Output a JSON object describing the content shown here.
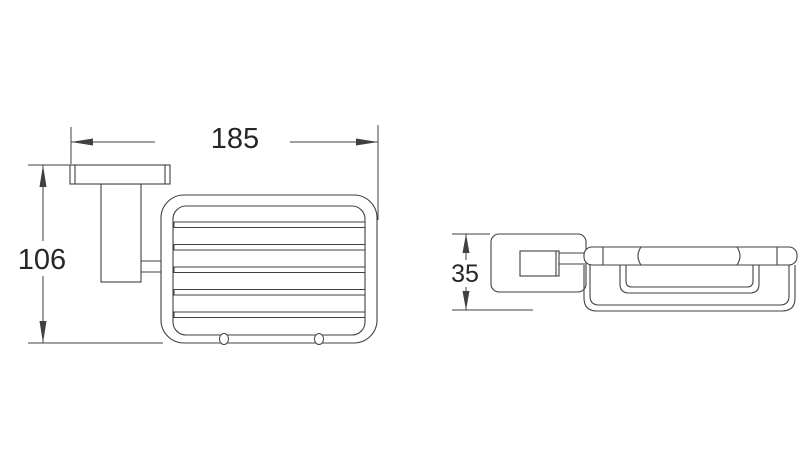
{
  "style": {
    "page_bg": "#ffffff",
    "line_color": "#404040",
    "text_color": "#262626"
  },
  "views": {
    "front": {
      "dimensions": {
        "width_mm": "185",
        "height_mm": "106"
      }
    },
    "side": {
      "dimensions": {
        "depth_mm": "35"
      }
    }
  }
}
